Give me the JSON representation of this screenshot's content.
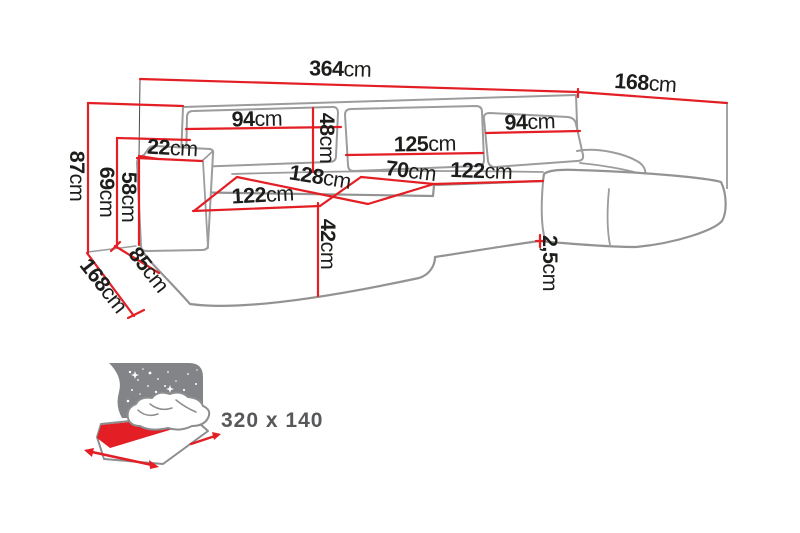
{
  "diagram": {
    "kind": "sofa-dimension-diagram",
    "unit_default": "cm",
    "dims": {
      "total_width": {
        "value": "364",
        "unit": "cm"
      },
      "depth_right": {
        "value": "168",
        "unit": "cm"
      },
      "back_left": {
        "value": "94",
        "unit": "cm"
      },
      "back_height": {
        "value": "48",
        "unit": "cm"
      },
      "back_middle": {
        "value": "125",
        "unit": "cm"
      },
      "back_right": {
        "value": "94",
        "unit": "cm"
      },
      "armrest_width": {
        "value": "22",
        "unit": "cm"
      },
      "height_total": {
        "value": "87",
        "unit": "cm"
      },
      "height_back": {
        "value": "69",
        "unit": "cm"
      },
      "height_armrest": {
        "value": "58",
        "unit": "cm"
      },
      "seat_depth": {
        "value": "128",
        "unit": "cm"
      },
      "seat_left": {
        "value": "122",
        "unit": "cm"
      },
      "seat_middle": {
        "value": "70",
        "unit": "cm"
      },
      "seat_right": {
        "value": "122",
        "unit": "cm"
      },
      "seat_height": {
        "value": "42",
        "unit": "cm"
      },
      "bottom_gap": {
        "value": "2,5",
        "unit": "cm"
      },
      "armrest_depth": {
        "value": "85",
        "unit": "cm"
      },
      "depth_left": {
        "value": "168",
        "unit": "cm"
      }
    },
    "sleeping_area": {
      "label": "320 x 140",
      "icon": "sofa-bed-icon"
    },
    "colors": {
      "dimension_red": "#e31e24",
      "outline_grey": "#9c9c9c",
      "panel_grey": "#828487",
      "label_dark": "#1d1d1b",
      "sleeping_label_grey": "#57585a"
    }
  }
}
